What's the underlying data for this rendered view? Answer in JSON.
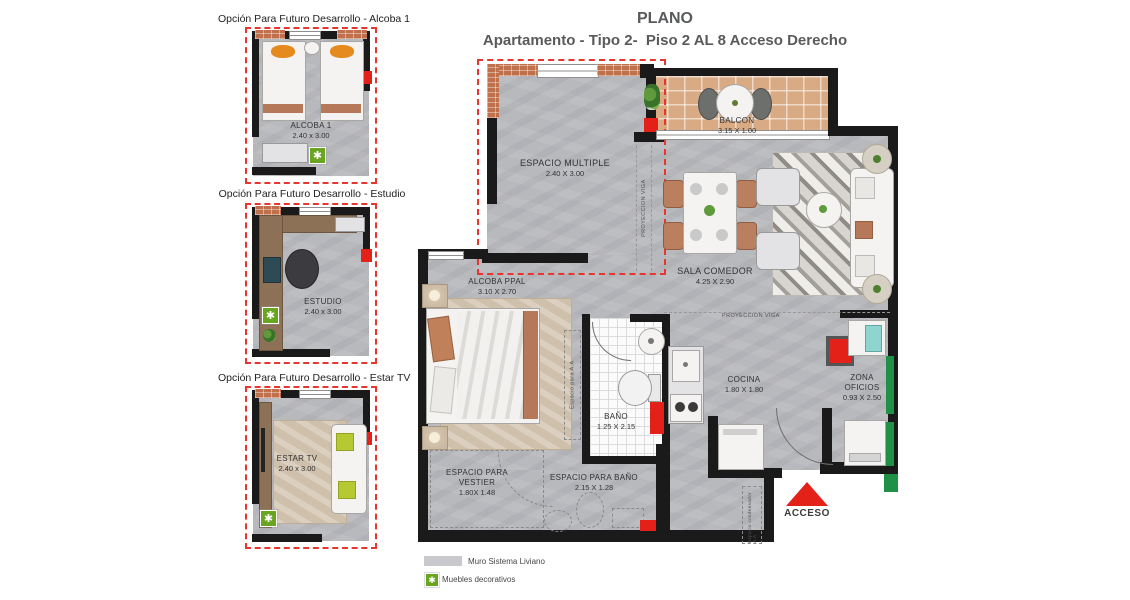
{
  "header": {
    "title": "PLANO",
    "subtitle": "Apartamento - Tipo 2-  Piso 2 AL 8 Acceso Derecho"
  },
  "options": [
    {
      "title": "Opción Para Futuro Desarrollo - Alcoba 1",
      "room": "ALCOBA 1",
      "dims": "2.40 x 3.00"
    },
    {
      "title": "Opción Para Futuro Desarrollo - Estudio",
      "room": "ESTUDIO",
      "dims": "2.40 x 3.00"
    },
    {
      "title": "Opción Para Futuro Desarrollo - Estar TV",
      "room": "ESTAR TV",
      "dims": "2.40 x 3.00"
    }
  ],
  "plan": {
    "rooms": {
      "espacio_multiple": {
        "name": "ESPACIO MULTIPLE",
        "dims": "2.40 X 3.00"
      },
      "balcon": {
        "name": "BALCON",
        "dims": "3.15 X 1.00"
      },
      "sala_comedor": {
        "name": "SALA COMEDOR",
        "dims": "4.25 X 2.90"
      },
      "alcoba_ppal": {
        "name": "ALCOBA PPAL",
        "dims": "3.10 X 2.70"
      },
      "bano": {
        "name": "BAÑO",
        "dims": "1.25 X 2.15"
      },
      "cocina": {
        "name": "COCINA",
        "dims": "1.80 X 1.80"
      },
      "zona_oficios": {
        "name": "ZONA",
        "name2": "OFICIOS",
        "dims": "0.93 X 2.50"
      },
      "espacio_vestier": {
        "name": "ESPACIO PARA",
        "name2": "VESTIER",
        "dims": "1.80X 1.48"
      },
      "espacio_bano": {
        "name": "ESPACIO PARA BAÑO",
        "dims": "2.15 X 1.28"
      }
    },
    "annotations": {
      "proyeccion_viga": "PROYECCION VIGA",
      "espacio_aa": "Espacio para A.A",
      "espacio_condensador": "Espacio condensador A.A",
      "acceso": "ACCESO"
    }
  },
  "legend": {
    "items": [
      {
        "label": "Muro Sistema Liviano"
      },
      {
        "label": "Muebles decorativos"
      }
    ]
  },
  "icons": {
    "furniture_marker": "✱"
  },
  "colors": {
    "wall": "#1a1a1a",
    "brick": "#c0714b",
    "floor_concrete": "#b8b9bd",
    "balcony_tile": "#d9ab85",
    "red_dashed": "#e8352e",
    "red_accent": "#e32119",
    "green_accent": "#1f9147",
    "furniture_green": "#6aa521",
    "teal_fixture": "#8fd4cf",
    "title_text": "#595a5c"
  }
}
